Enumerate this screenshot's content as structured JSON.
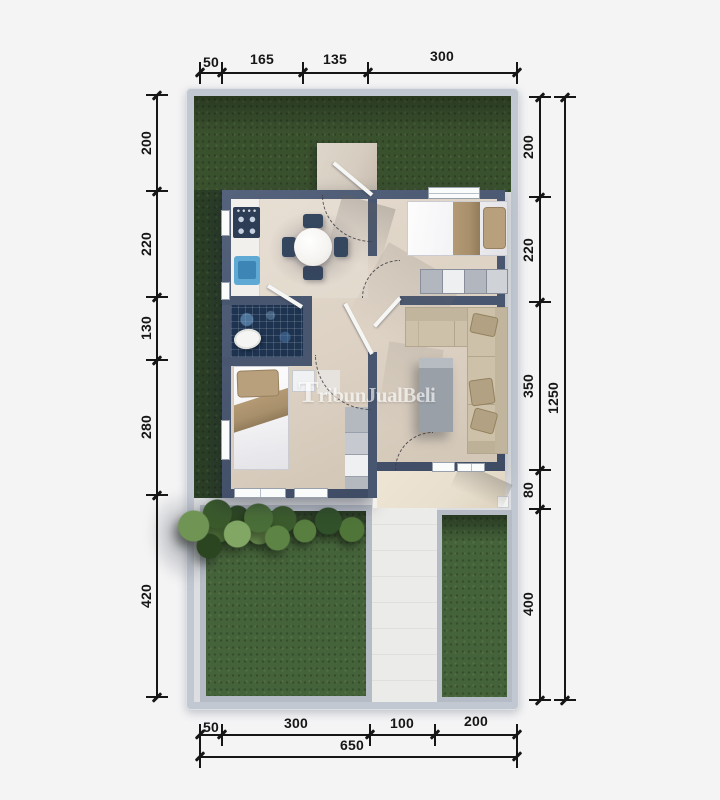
{
  "watermark": {
    "text": "TribunJualBeli"
  },
  "dimensions": {
    "top": {
      "segments": [
        {
          "label": "50"
        },
        {
          "label": "165"
        },
        {
          "label": "135"
        },
        {
          "label": "300"
        }
      ]
    },
    "left": {
      "segments": [
        {
          "label": "200"
        },
        {
          "label": "220"
        },
        {
          "label": "130"
        },
        {
          "label": "280"
        },
        {
          "label": "420"
        }
      ]
    },
    "right": {
      "segments": [
        {
          "label": "200"
        },
        {
          "label": "220"
        },
        {
          "label": "350"
        },
        {
          "label": "80"
        },
        {
          "label": "400"
        }
      ],
      "total": "1250"
    },
    "bottom": {
      "segments": [
        {
          "label": "50"
        },
        {
          "label": "300"
        },
        {
          "label": "100"
        },
        {
          "label": "200"
        }
      ],
      "total": "650"
    }
  },
  "colors": {
    "background": "#f4f4f5",
    "plot_frame": "#c2c8d1",
    "plot_base": "#dcdee1",
    "grass_front": "#3a512e",
    "grass_back": "#45633a",
    "grass_side": "#2b3f26",
    "house_wall": "#49566f",
    "floor": "#ddd2c4",
    "kitchen_counter": "#f1f0ed",
    "stove": "#2d3d56",
    "sink": "#5fa9d5",
    "dining_table": "#f4f3f0",
    "chair": "#35465f",
    "bath_tile": "#1d3350",
    "toilet": "#f5f5f4",
    "duvet": "#f3f3f5",
    "blanket": "#a8906c",
    "pillow": "#b9a07c",
    "dresser_light": "#edeff1",
    "dresser_gray": "#b2b7bf",
    "sofa": "#cdc1a9",
    "sofa_pillow": "#b3a184",
    "coffee_table": "#9aa0a8",
    "wardrobe": "#b4b9c0",
    "walkway": "#d6cdc0",
    "terrace": "#e8dfce",
    "path": "#ebebe9",
    "window": "#fafbfb",
    "dimension": "#161616",
    "watermark": "#ffffff"
  }
}
